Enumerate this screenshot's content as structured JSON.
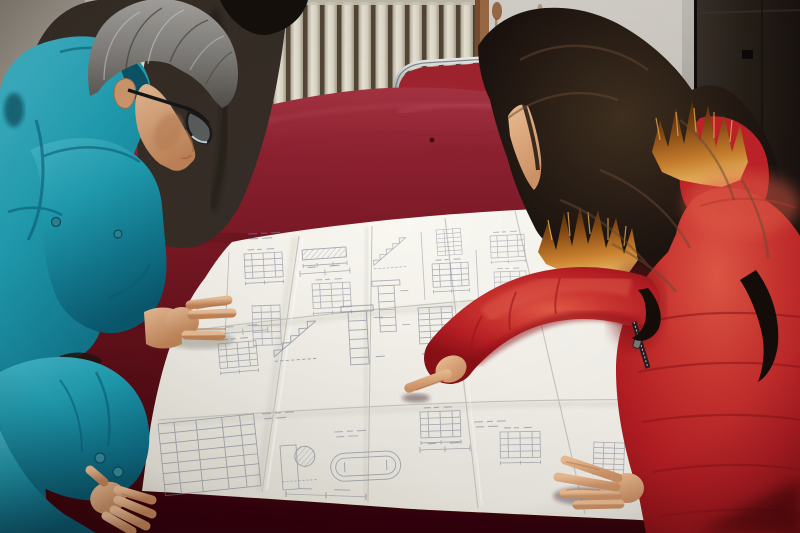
{
  "meta": {
    "type": "photograph",
    "description": "Two people reviewing a large folded construction blueprint spread on a dark red velvet table; a gray-haired man in a teal work jacket and glasses leans over the drawing at left while a woman in a red fur-trimmed parka points at a detail; a third person in a dark jacket stands behind; cream radiator, gray wall and dark door in the background",
    "width_px": 800,
    "height_px": 533
  },
  "scene": {
    "people": [
      {
        "id": "man-left",
        "description": "middle-aged man with gray hair and dark-rimmed glasses wearing a teal work jacket, both hands resting on the blueprint"
      },
      {
        "id": "person-behind",
        "description": "partially visible person in a dark brown jacket standing behind the man"
      },
      {
        "id": "woman-right",
        "description": "woman with long dark wavy hair in a red hooded parka with orange fur trim, pointing at the blueprint with her index finger"
      }
    ],
    "objects": [
      {
        "id": "blueprint",
        "description": "large folded white engineering drawing sheet covered in small stair sections, detail views, dimension lines and schedule tables"
      },
      {
        "id": "table",
        "description": "table draped in dark red velvet"
      },
      {
        "id": "chair",
        "description": "chrome-framed chair with red seat back behind the table"
      },
      {
        "id": "radiator",
        "description": "cream wall radiator with vertical fins"
      },
      {
        "id": "door",
        "description": "dark brown door at right with pale frame"
      },
      {
        "id": "wall",
        "description": "plain plaster wall with small rust stains"
      }
    ]
  },
  "colors": {
    "ink": "#7c8296",
    "paper": "#f2efe8",
    "velvet": "#6f1520",
    "velvet_dark": "#37050b",
    "teal_jacket": "#1f97ad",
    "teal_shadow": "#0a5a70",
    "man_hair_gray": "#8e8c87",
    "skin_man": "#dca57f",
    "skin_woman": "#e8b58a",
    "dark_jacket": "#362e27",
    "woman_hair": "#1d130d",
    "fur_trim": "#cf8430",
    "coat_red": "#c32429",
    "coat_highlight": "#e4544a",
    "coat_shadow": "#8a1016",
    "chair_red": "#a22430",
    "chrome": "#c2c6c6",
    "radiator_cream": "#e4e0d2",
    "radiator_gap": "#544737",
    "wood_trim": "#9c6c46",
    "wall_left": "#a49e93",
    "wall_right": "#cbc7bf",
    "door_brown": "#271f1a",
    "door_frame": "#aaa69e",
    "rust": "#8a4a1e"
  }
}
